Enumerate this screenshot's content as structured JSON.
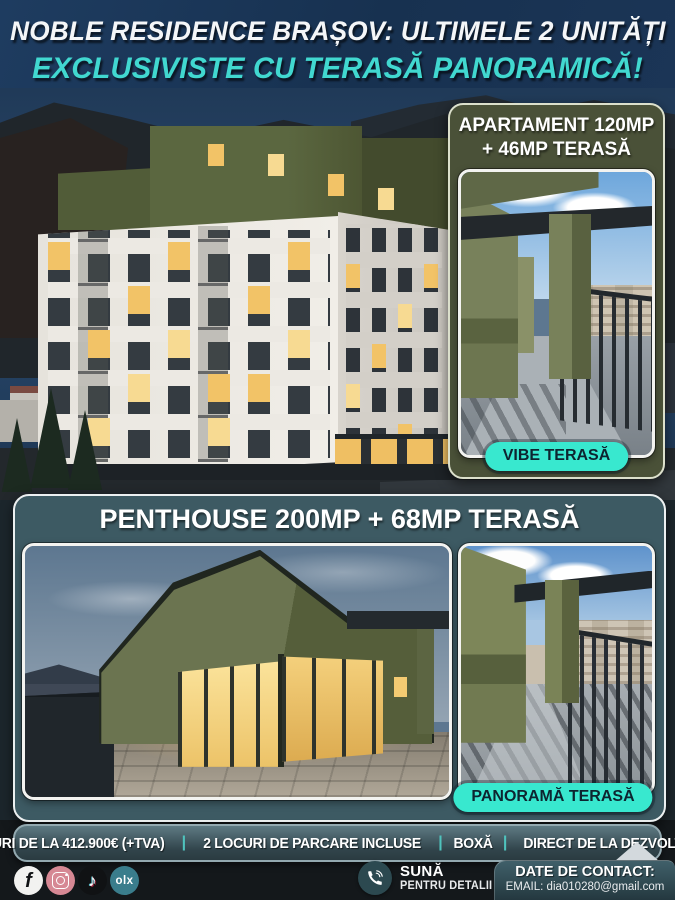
{
  "header": {
    "line1": "NOBLE RESIDENCE BRAȘOV: ULTIMELE 2 UNITĂȚI",
    "line2": "EXCLUSIVISTE CU TERASĂ PANORAMICĂ!"
  },
  "apartment": {
    "title1": "APARTAMENT 120MP",
    "title2": "+ 46MP TERASĂ",
    "badge": "VIBE TERASĂ"
  },
  "penthouse": {
    "title": "PENTHOUSE 200MP + 68MP TERASĂ",
    "badge": "PANORAMĂ TERASĂ"
  },
  "pricing": {
    "items": [
      "PREȚURI DE LA 412.900€ (+TVA)",
      "2 LOCURI DE PARCARE INCLUSE",
      "BOXĂ",
      "DIRECT DE LA DEZVOLTATOR"
    ],
    "separator": "|"
  },
  "footer": {
    "social": {
      "facebook_glyph": "f",
      "tiktok_glyph": "♪",
      "olx_label": "olx"
    },
    "call": {
      "title": "SUNĂ",
      "subtitle": "PENTRU DETALII"
    },
    "contact": {
      "title": "DATE DE CONTACT:",
      "email": "EMAIL: dia010280@gmail.com"
    }
  },
  "colors": {
    "accent_teal": "#41d8d0",
    "badge_teal": "#38e8cf",
    "panel_olive": "#4a5138",
    "panel_slate": "#3d5a63",
    "price_separator": "#4fc3bd"
  },
  "icons": {
    "facebook": "facebook-icon",
    "instagram": "instagram-icon",
    "tiktok": "tiktok-icon",
    "olx": "olx-icon",
    "phone": "phone-icon",
    "diamond": "diamond-ornament"
  }
}
